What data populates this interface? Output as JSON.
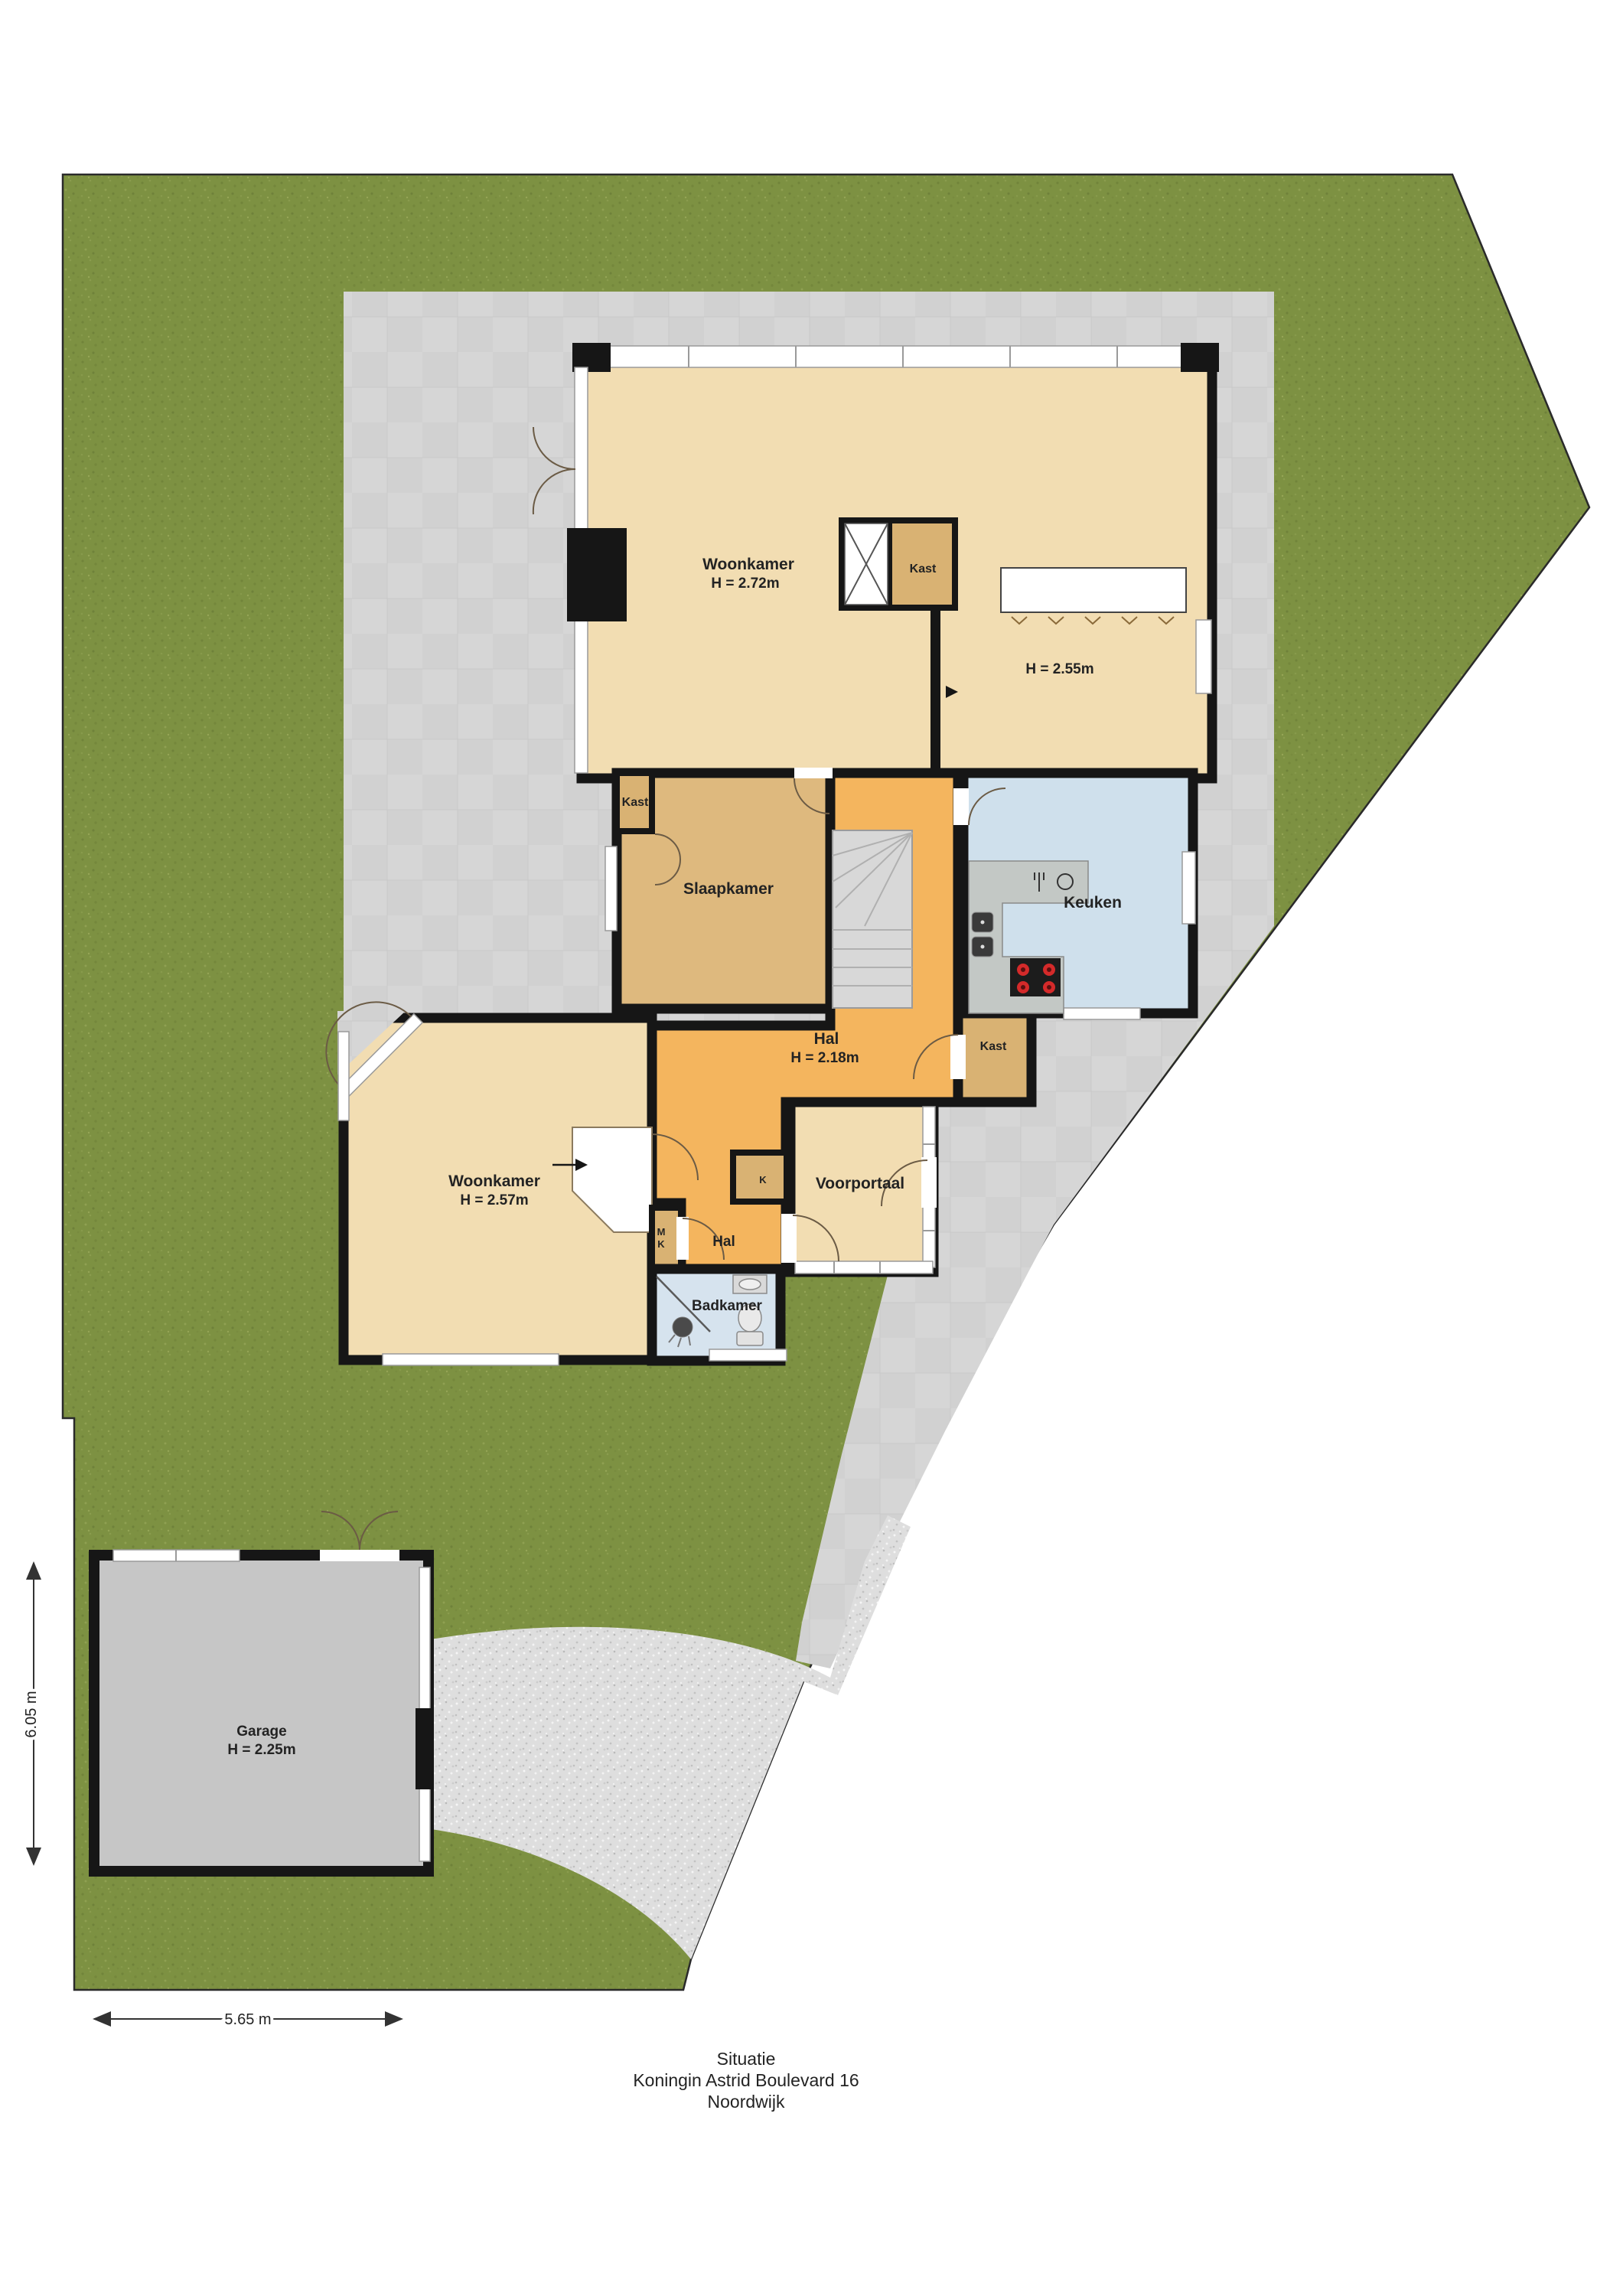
{
  "plan": {
    "type": "floorplan-situation",
    "title": {
      "line1": "Situatie",
      "line2": "Koningin Astrid Boulevard 16",
      "line3": "Noordwijk"
    },
    "dimensions": {
      "plot_left": "6.05 m",
      "plot_bottom": "5.65 m"
    },
    "rooms": {
      "woonkamer_boven": {
        "label": "Woonkamer",
        "height": "H = 2.72m"
      },
      "kamer_rechts": {
        "height": "H = 2.55m"
      },
      "kast_schacht": {
        "label": "Kast"
      },
      "slaapkamer": {
        "label": "Slaapkamer"
      },
      "slaapkamer_kast": {
        "label": "Kast"
      },
      "keuken": {
        "label": "Keuken"
      },
      "hal": {
        "label": "Hal",
        "height": "H = 2.18m"
      },
      "kast_hal": {
        "label": "Kast"
      },
      "woonkamer_beneden": {
        "label": "Woonkamer",
        "height": "H = 2.57m"
      },
      "voorportaal": {
        "label": "Voorportaal"
      },
      "hal_beneden": {
        "label": "Hal"
      },
      "meterkast": {
        "line1": "M",
        "line2": "K"
      },
      "kast_k": {
        "label": "K"
      },
      "badkamer": {
        "label": "Badkamer"
      },
      "garage": {
        "label": "Garage",
        "height": "H = 2.25m"
      }
    },
    "colors": {
      "grass": "#7d9142",
      "paving": "#d6d6d6",
      "gravel": "#dedede",
      "floor_beige": "#f2ddb2",
      "floor_tan": "#deb97e",
      "floor_tan_dark": "#d9b273",
      "floor_orange": "#f4b55e",
      "floor_kitchen": "#cfe0ec",
      "floor_bath": "#d6e3ee",
      "floor_garage": "#c6c6c6",
      "wall": "#161616"
    }
  }
}
